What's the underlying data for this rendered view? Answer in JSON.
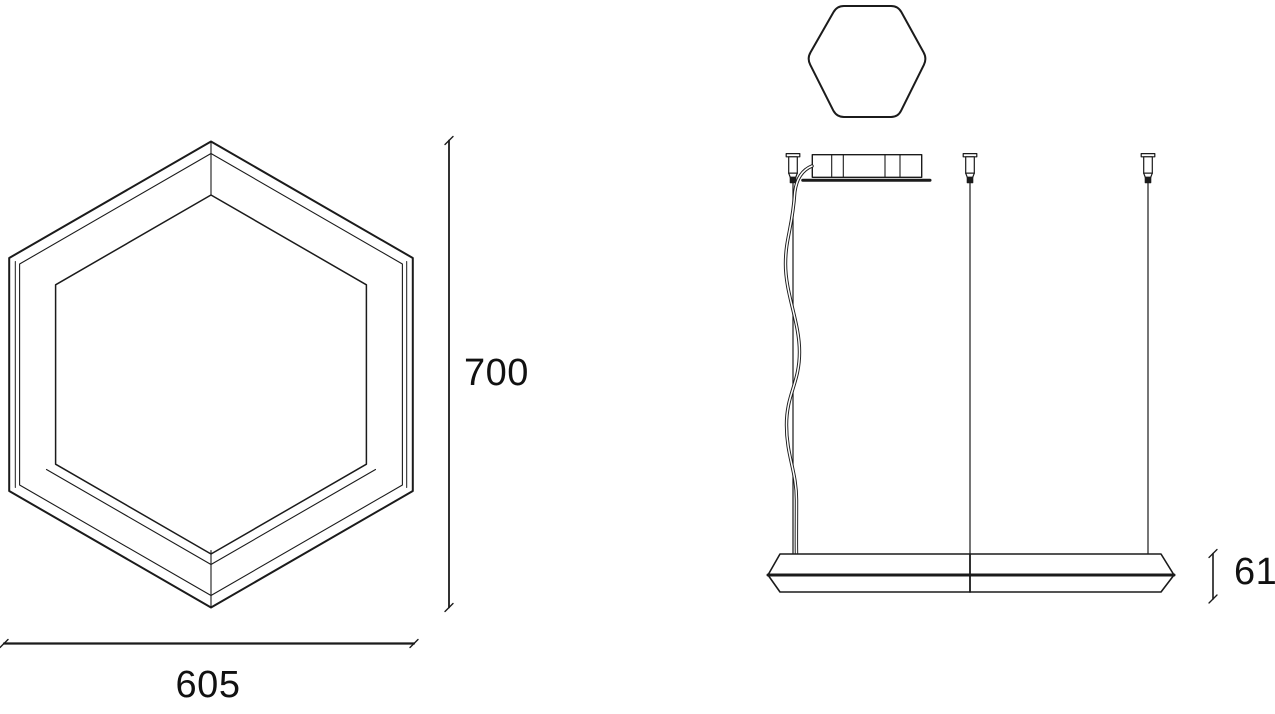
{
  "colors": {
    "background": "#ffffff",
    "line": "#1b1b1b",
    "text": "#111111"
  },
  "drawing": {
    "type": "technical-dimension-drawing",
    "views": {
      "front": "hexagonal-frame-luminaire-front-view",
      "top": "hexagonal-canopy-top-view",
      "side": "suspended-luminaire-side-view"
    }
  },
  "dimensions": {
    "height": {
      "value": "700"
    },
    "width": {
      "value": "605"
    },
    "thickness": {
      "value": "61"
    }
  }
}
